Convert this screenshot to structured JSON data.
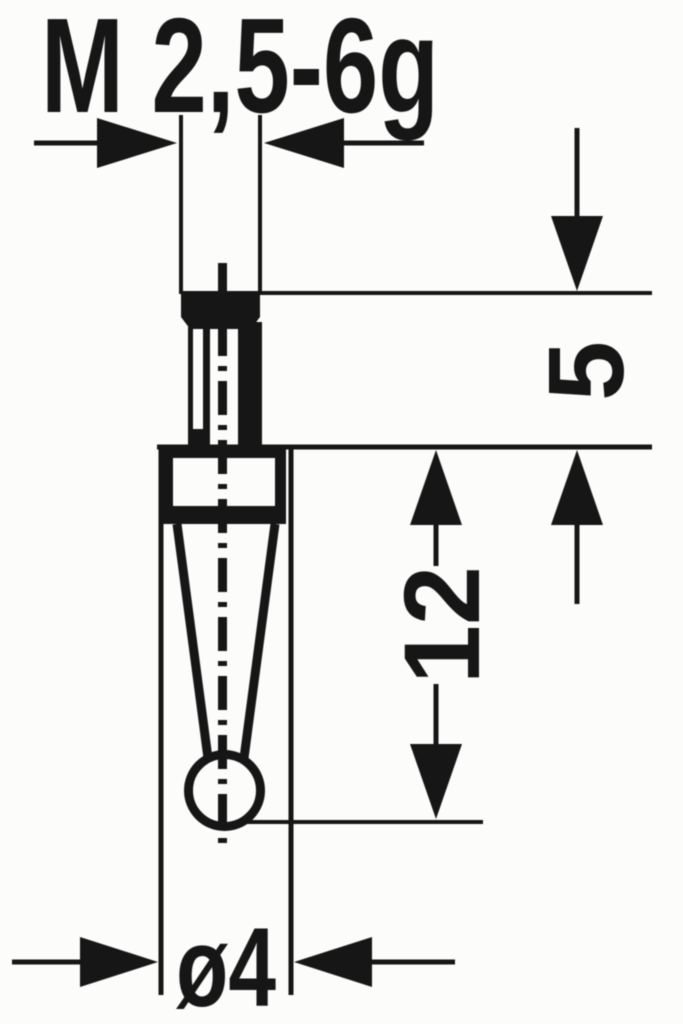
{
  "drawing": {
    "background": "#fcfcfb",
    "line_color": "#161616",
    "labels": {
      "thread_designation": "M 2,5-6g",
      "dim_thread_length": "5",
      "dim_tip_length": "12",
      "dim_diameter": "ø4"
    }
  }
}
